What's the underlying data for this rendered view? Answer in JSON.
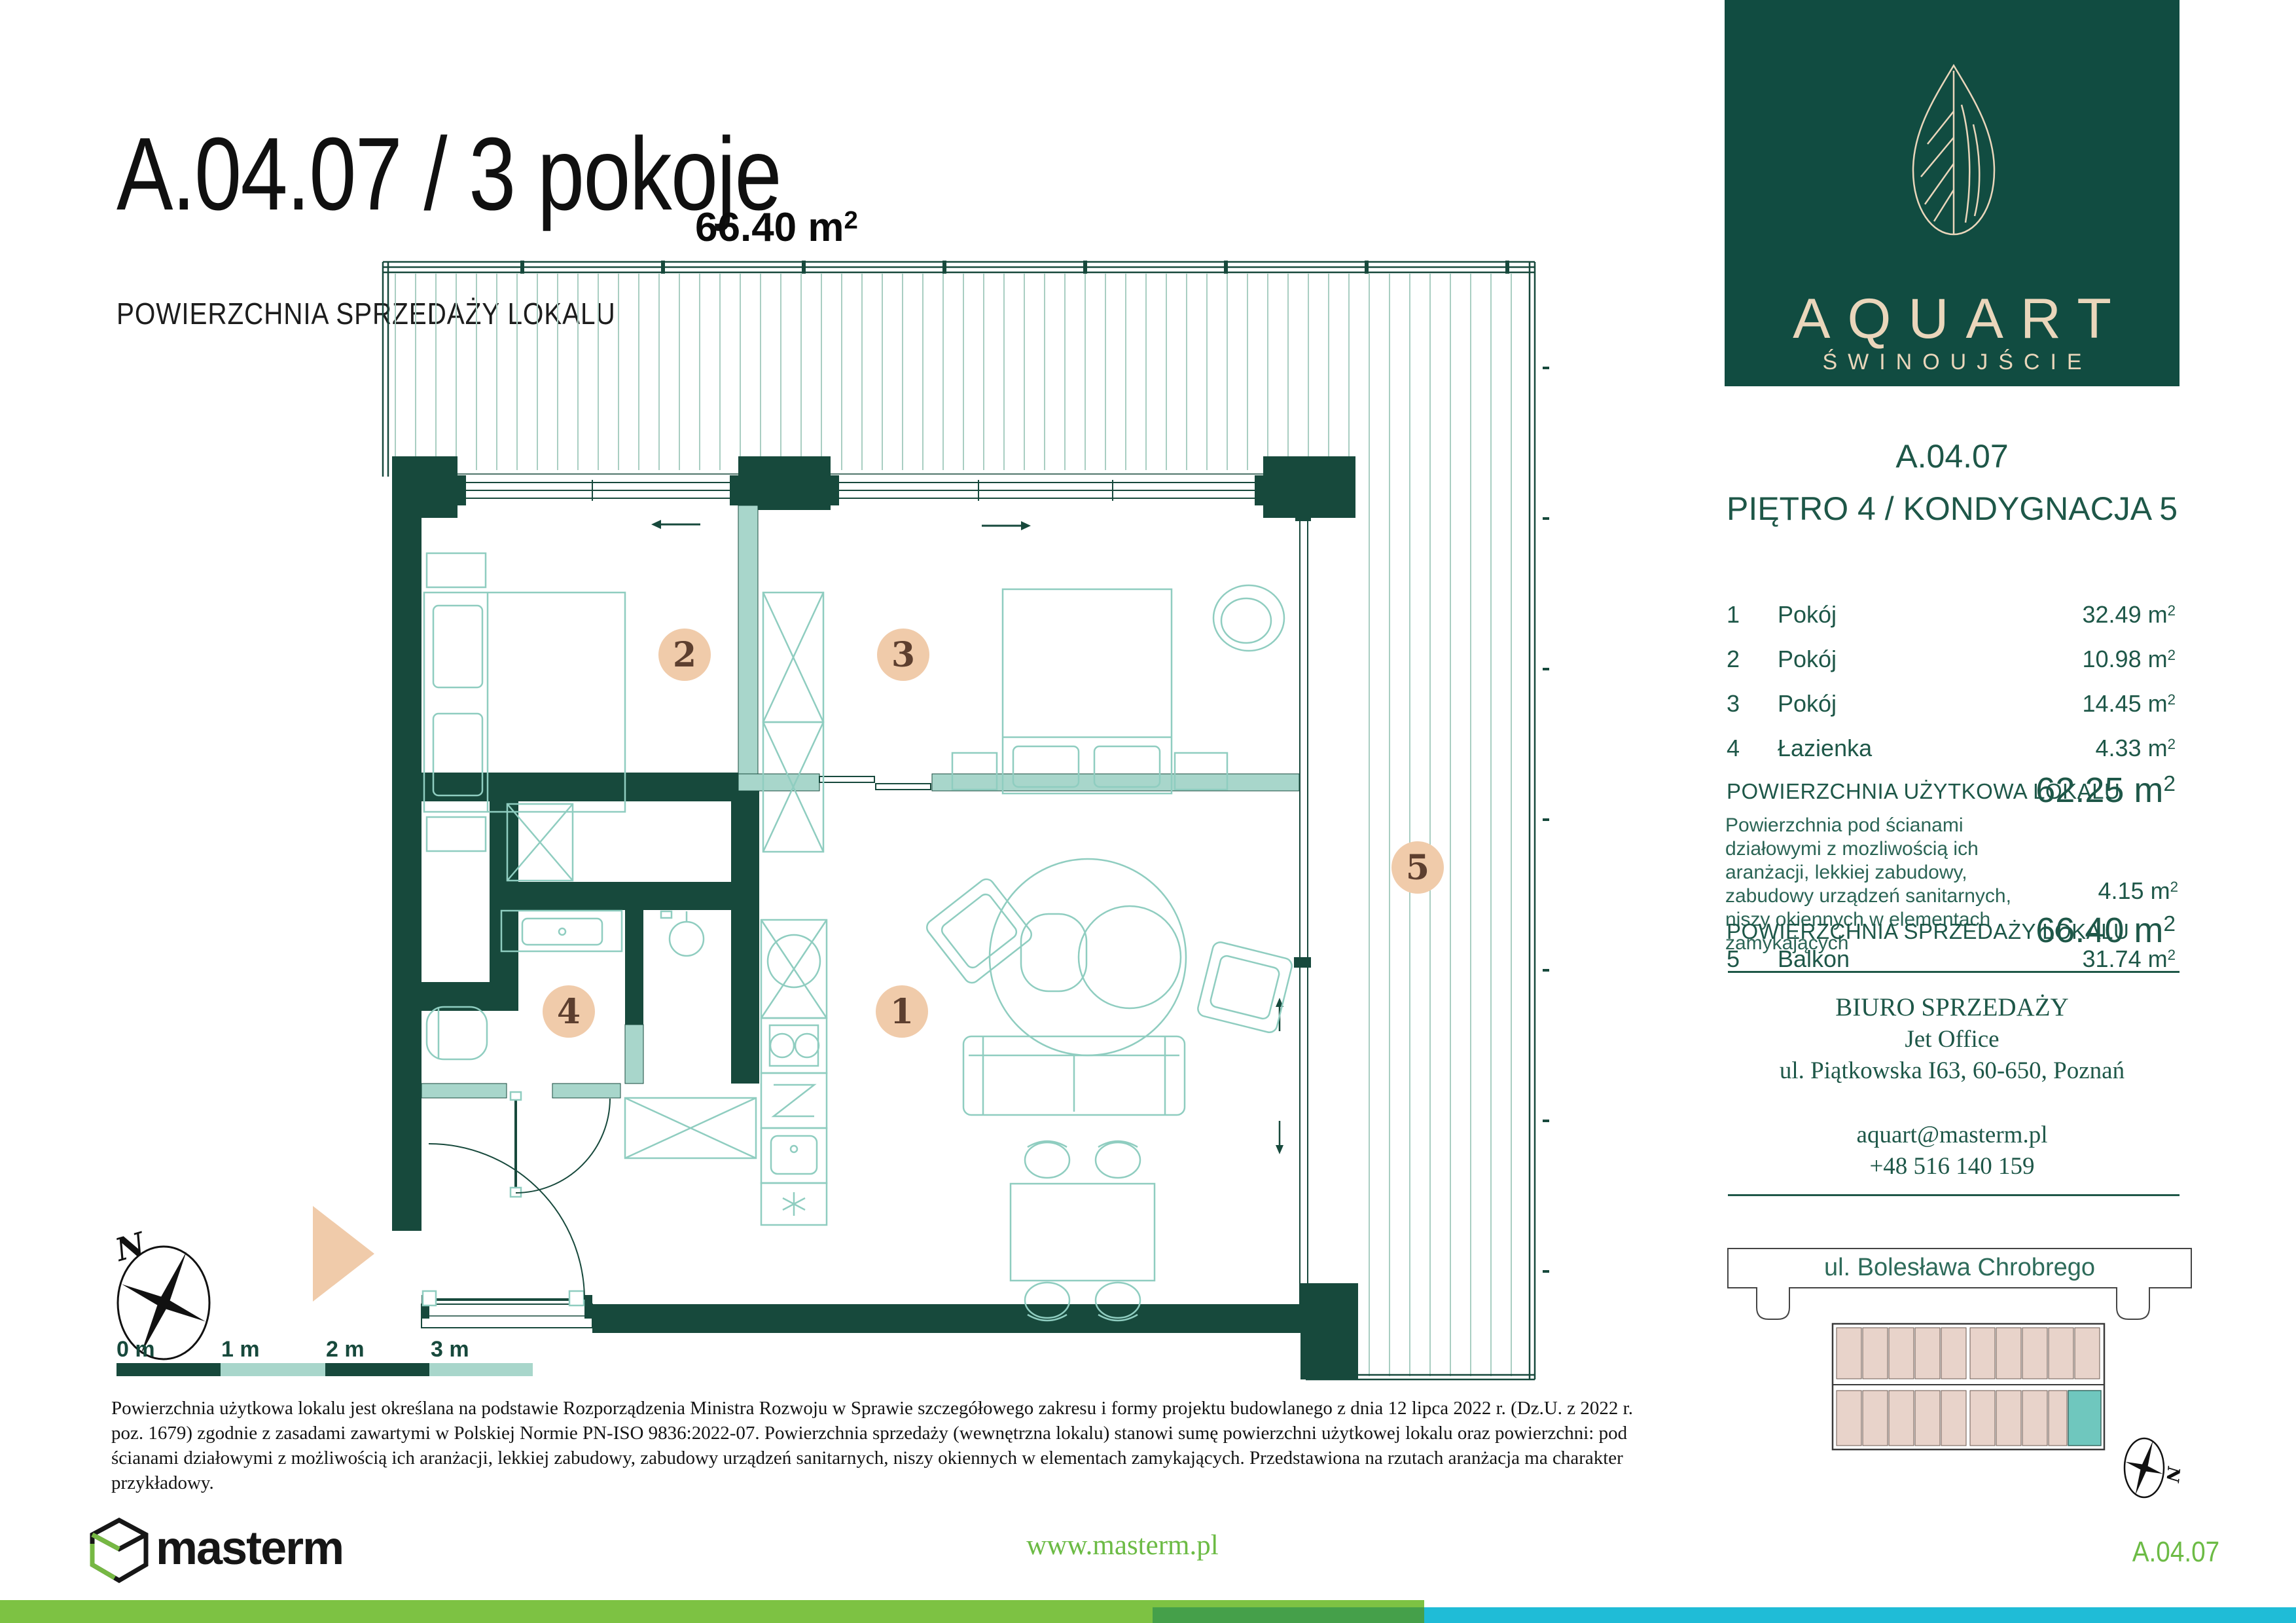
{
  "header": {
    "title": "A.04.07 /  3 pokoje",
    "area_label": "POWIERZCHNIA SPRZEDAŻY LOKALU",
    "area_value": "66.40 m",
    "area_sup": "2"
  },
  "brand": {
    "name": "AQUART",
    "city": "ŚWINOUJŚCIE"
  },
  "panel": {
    "code": "A.04.07",
    "floor_line": "PIĘTRO 4 / KONDYGNACJA 5",
    "rooms": [
      {
        "no": "1",
        "name": "Pokój",
        "area": "32.49 m",
        "sup": "2"
      },
      {
        "no": "2",
        "name": "Pokój",
        "area": "10.98 m",
        "sup": "2"
      },
      {
        "no": "3",
        "name": "Pokój",
        "area": "14.45 m",
        "sup": "2"
      },
      {
        "no": "4",
        "name": "Łazienka",
        "area": "4.33 m",
        "sup": "2"
      }
    ],
    "usable_label": "POWIERZCHNIA UŻYTKOWA LOKALU",
    "usable_value": "62.25 m",
    "usable_sup": "2",
    "note_lines": "Powierzchnia pod ścianami działowymi z mozliwością ich aranżacji, lekkiej zabudowy, zabudowy urządzeń sanitarnych, niszy okiennych w elementach zamykających",
    "note_value": "4.15 m",
    "note_sup": "2",
    "sale_label": "POWIERZCHNIA SPRZEDAŻY LOKALU",
    "sale_value": "66.40 m",
    "sale_sup": "2",
    "balcony": {
      "no": "5",
      "name": "Balkon",
      "area": "31.74 m",
      "sup": "2"
    }
  },
  "office": {
    "title": "BIURO SPRZEDAŻY",
    "company": "Jet Office",
    "address": "ul. Piątkowska I63, 60-650, Poznań",
    "email": "aquart@masterm.pl",
    "phone": "+48 516 140 159"
  },
  "site": {
    "street": "ul. Bolesława Chrobrego",
    "compass": "N"
  },
  "plan": {
    "badges": [
      "1",
      "2",
      "3",
      "4",
      "5"
    ],
    "scale_labels": [
      "0 m",
      "1 m",
      "2 m",
      "3 m"
    ],
    "compass": "N"
  },
  "disclaimer": "Powierzchnia użytkowa lokalu jest określana na podstawie Rozporządzenia Ministra Rozwoju w Sprawie szczegółowego zakresu i formy projektu budowlanego z dnia 12 lipca 2022 r. (Dz.U. z 2022 r. poz. 1679) zgodnie z zasadami zawartymi w Polskiej Normie PN-ISO 9836:2022-07. Powierzchnia sprzedaży (wewnętrzna lokalu) stanowi sumę powierzchni użytkowej lokalu oraz powierzchni: pod ścianami działowymi z możliwością ich aranżacji, lekkiej zabudowy, zabudowy urządzeń sanitarnych, niszy okiennych w elementach zamykających. Przedstawiona na rzutach aranżacja ma charakter przykładowy.",
  "footer": {
    "brand": "masterm",
    "website": "www.masterm.pl",
    "unit_code": "A.04.07"
  },
  "colors": {
    "wall": "#17493C",
    "panelgreen": "#114C41",
    "cream": "#EAD6BB",
    "lightteal": "#A8D6CB",
    "furn": "#8FCDC0",
    "hatch": "#A9CEC2",
    "badgefill": "#F0CBAA",
    "badgetext": "#5D3F2F",
    "textgreen": "#1E5748",
    "footgreen": "#7DC243",
    "footdark": "#45A04A",
    "footteal": "#1FBCD7",
    "brandgreen": "#6CBB45",
    "sitepink": "#E8D3CA",
    "siteteal": "#6FC7BE"
  }
}
